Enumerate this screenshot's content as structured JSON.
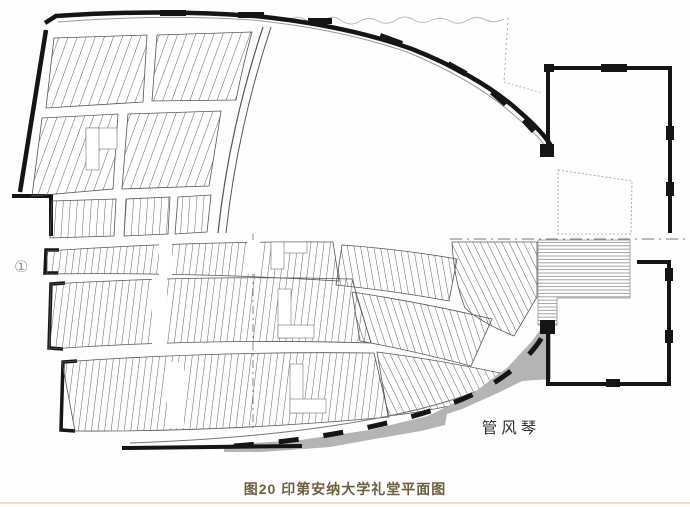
{
  "page": {
    "width": 690,
    "height": 507,
    "background": "#ffffff"
  },
  "figure": {
    "caption": "图20 印第安纳大学礼堂平面图",
    "caption_color": "#6d5e3e",
    "divider_color": "#f4dbc6"
  },
  "plan": {
    "labels": {
      "organ": "管风琴",
      "section_marker": "①"
    },
    "colors": {
      "wall": "#151515",
      "seat_row_line": "#4f4f4f",
      "shaded_area": "#b4b4b4",
      "faint_line": "#aaaaaa"
    }
  }
}
